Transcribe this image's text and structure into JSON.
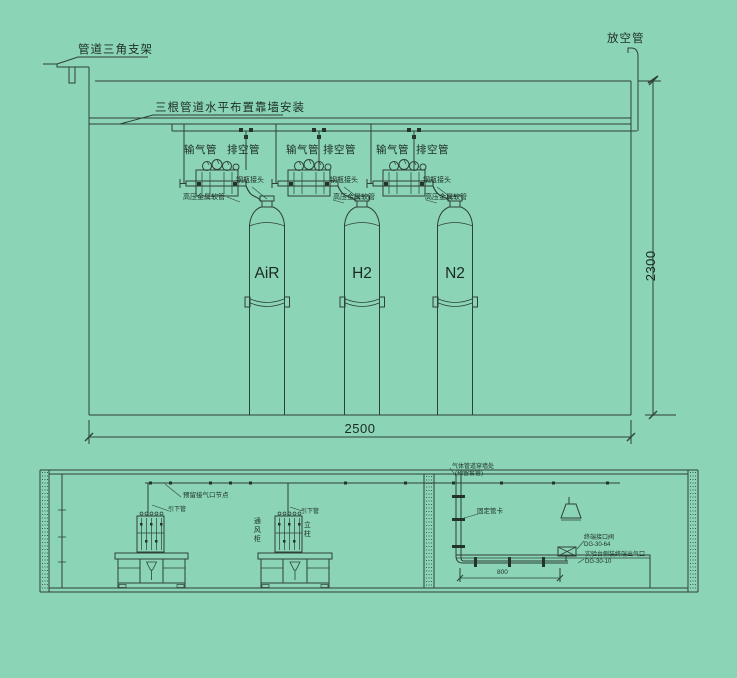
{
  "top_drawing": {
    "bracket_label": "管道三角支架",
    "pipes_label": "三根管道水平布置靠墙安装",
    "vent_label": "放空管",
    "stations": [
      {
        "gas": "AiR",
        "supply_label": "输气管",
        "exhaust_label": "排空管",
        "connector_label": "钢瓶接头",
        "hose_label": "高压金属软管"
      },
      {
        "gas": "H2",
        "supply_label": "输气管",
        "exhaust_label": "排空管",
        "connector_label": "钢瓶接头",
        "hose_label": "高压金属软管"
      },
      {
        "gas": "N2",
        "supply_label": "输气管",
        "exhaust_label": "排空管",
        "connector_label": "钢瓶接头",
        "hose_label": "高压金属软管"
      }
    ],
    "dims": {
      "width": "2500",
      "height": "2300"
    }
  },
  "bottom_drawing": {
    "ceiling_pipe_label": "预留接气口节点",
    "downpipe_label_1": "引下管",
    "downpipe_label_2": "引下管",
    "fume_hood_label": "通风柜",
    "column_label": "立柱",
    "wall_sleeve_label_1": "气体管道穿墙处",
    "wall_sleeve_label_2": "(预留套管)",
    "clamp_label": "固定管卡",
    "terminal_label_1": "终端接口阀",
    "terminal_label_2": "DG-30-64",
    "outlet_label_1": "实验台侧装终端出气口",
    "outlet_label_2": "DG-30-10",
    "pipe_dim": "800"
  },
  "colors": {
    "background": "#8bd5b6",
    "line": "#2e4038",
    "text": "#1d2c25"
  }
}
